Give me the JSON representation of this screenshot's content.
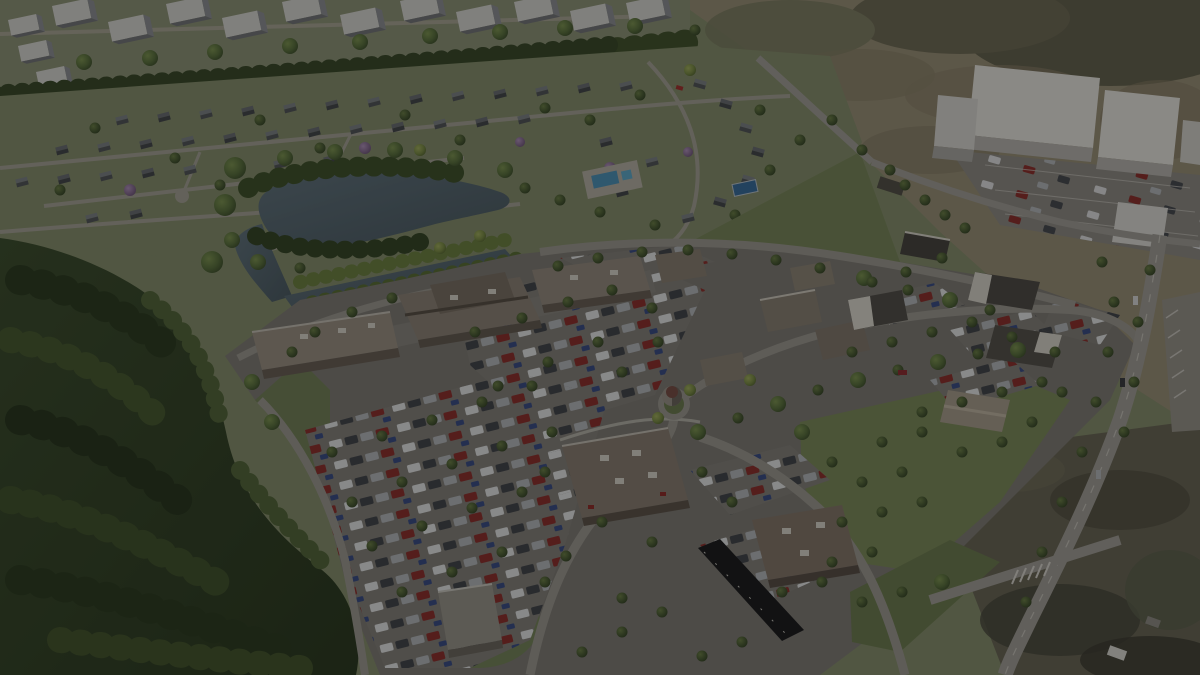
{
  "image": {
    "type": "3d-aerial-site-rendering",
    "alt": "Darkened aerial rendering of a planned suburban mixed-use development: a retail center with tree-lined parking lots and outparcel buildings in the center, a pond and residential neighborhood with apartment blocks behind it, dense forest to the left, open tan fields with white big-box massing buildings at the upper right, and an arterial road along the right edge.",
    "overlay": {
      "color": "#000000",
      "opacity": 0.4
    }
  },
  "palette": {
    "forest_green": "#3a4a2e",
    "lawn_green": "#7c8a5e",
    "ground_green": "#87906e",
    "field_tan": "#9a9179",
    "asphalt": "#807d77",
    "road": "#9d9a92",
    "retail_roof": "#94897a",
    "white_building": "#e6e4de",
    "pond_water": "#5d6d74",
    "pool_water": "#4f93b8",
    "flowering_tree": "#9a7fa5",
    "car_red": "#8e3330"
  },
  "elements": [
    "apartment-blocks",
    "residential-neighborhood",
    "community-pool",
    "pond",
    "canal",
    "forest",
    "retail-center",
    "parking-lots",
    "outparcel-buildings",
    "water-tower",
    "restaurant-pad",
    "drive-thru-canopy",
    "big-box-stores",
    "field",
    "arterial-road",
    "dark-overlay"
  ]
}
